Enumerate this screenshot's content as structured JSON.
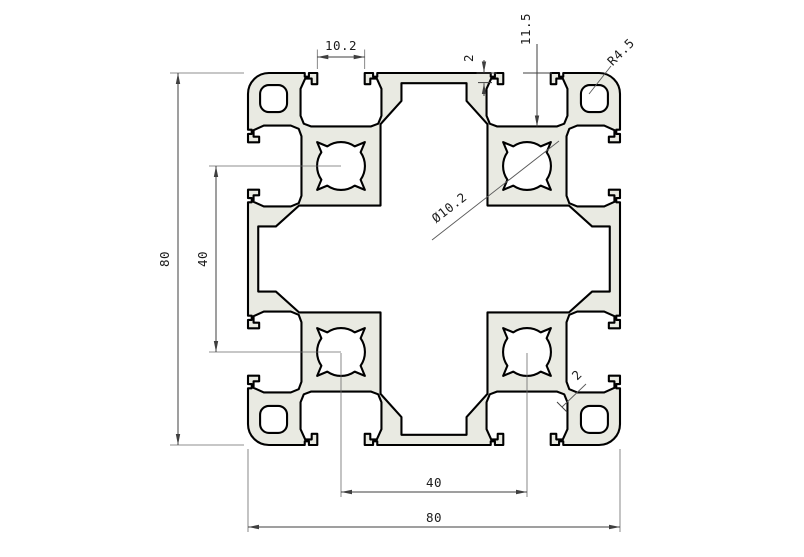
{
  "drawing": {
    "type": "technical-section-drawing",
    "subject": "aluminium-extrusion-profile-80x80",
    "colors": {
      "background": "#ffffff",
      "body_fill": "#e9eae2",
      "outline": "#000000",
      "dimension": "#3f3f3f"
    },
    "dimensions": {
      "slot_opening_width": {
        "label": "10.2"
      },
      "top_wall_thickness": {
        "label": "2"
      },
      "slot_depth": {
        "label": "11.5"
      },
      "corner_radius": {
        "label": "R4.5"
      },
      "center_hole_diameter": {
        "label": "Ø10.2"
      },
      "overall_height": {
        "label": "80"
      },
      "hole_pitch_vertical": {
        "label": "40"
      },
      "hole_pitch_horizontal": {
        "label": "40"
      },
      "overall_width": {
        "label": "80"
      },
      "rib_wall_thickness": {
        "label": "2"
      }
    }
  }
}
